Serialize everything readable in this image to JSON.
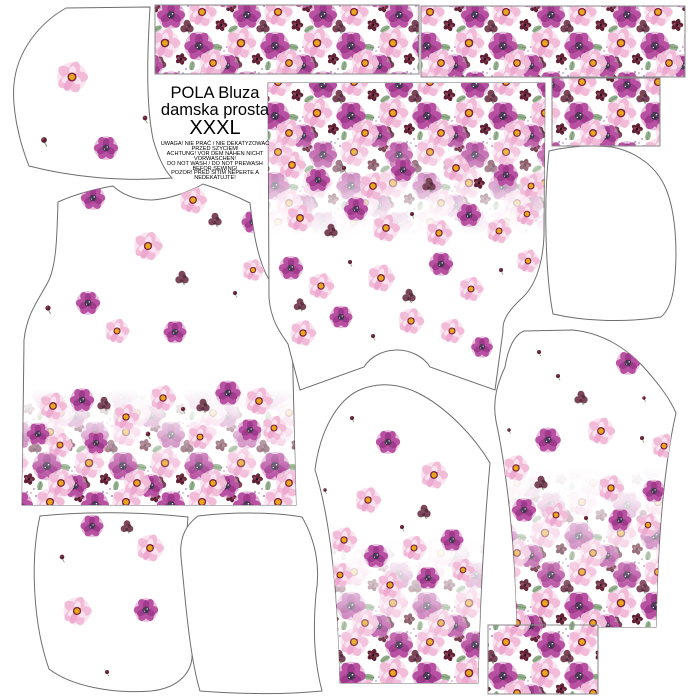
{
  "meta": {
    "title1": "POLA Bluza",
    "title2": "damska prosta",
    "size": "XXXL"
  },
  "warnings": [
    "UWAGA! NIE PRAĆ / NIE DEKATYZOWAĆ",
    "PRZED SZYCIEM!",
    "ACHTUNG! VOR DEM NÄHEN NICHT",
    "VORWASCHEN!",
    "DO NOT WASH / DO NOT PREWASH",
    "BEFOR SEWING!",
    "POZOR! PŘED ŠITÍM NEPERTE A",
    "NEDEKATUJTE!"
  ],
  "colors": {
    "outline": "#6e6e6e",
    "rect_border": "#8a8a8a",
    "magenta": "#b851a2",
    "magenta_dark": "#a03a8c",
    "pink_light": "#f2bcd9",
    "pink_pale": "#f7d9ea",
    "yellow_center": "#e9a81c",
    "wine": "#5f2133",
    "clover": "#7c4659",
    "leaf_green": "#93b08c",
    "flower_eye": "#4a3a56"
  },
  "dense_rects": [
    {
      "id": "top-border-strip-left",
      "x": 155,
      "y": 5,
      "w": 264,
      "h": 69
    },
    {
      "id": "top-border-strip-right",
      "x": 421,
      "y": 6,
      "w": 264,
      "h": 71
    },
    {
      "id": "cuff-rect-top-right",
      "x": 552,
      "y": 78,
      "w": 108,
      "h": 68
    },
    {
      "id": "cuff-rect-bottom-right",
      "x": 488,
      "y": 625,
      "w": 110,
      "h": 69
    }
  ],
  "pieces": [
    {
      "id": "hood-side-top-left",
      "path": "M 66,8 L 150,7 C 147,58 146,104 153,139 C 158,157 164,170 172,178 C 122,182 72,177 29,166 C 17,136 12,104 14,84 C 17,52 38,24 66,8 Z",
      "flowers": [
        [
          "pinkY",
          72,
          77,
          1.15
        ],
        [
          "bud",
          44,
          140,
          1.0
        ],
        [
          "magenta",
          106,
          148,
          0.95
        ],
        [
          "bud",
          145,
          118,
          0.8
        ]
      ]
    },
    {
      "id": "front-bodice-left",
      "path": "M 58,202 C 76,194 95,189 113,186 C 125,197 140,200 152,200 C 168,199 187,193 203,184 C 219,189 236,196 250,203 C 253,230 257,255 266,274 C 276,293 290,308 292,332 L 296,505 L 22,505 L 24,340 C 27,312 40,298 49,280 C 57,262 57,230 58,202 Z",
      "band": {
        "x": 22,
        "y": 388,
        "w": 276,
        "h": 118,
        "solid": "bottom"
      },
      "flowers": [
        [
          "magenta",
          93,
          198,
          0.95
        ],
        [
          "pinkY",
          193,
          200,
          1.0
        ],
        [
          "clover",
          215,
          220,
          0.8
        ],
        [
          "magenta",
          253,
          222,
          0.9
        ],
        [
          "pinkY",
          148,
          246,
          1.05
        ],
        [
          "pinkY",
          253,
          270,
          0.8
        ],
        [
          "magenta",
          88,
          303,
          0.95
        ],
        [
          "bud",
          48,
          308,
          0.9
        ],
        [
          "clover",
          182,
          278,
          0.8
        ],
        [
          "bud",
          235,
          293,
          0.7
        ],
        [
          "magenta",
          175,
          332,
          0.9
        ],
        [
          "pinkY",
          117,
          331,
          0.9
        ],
        [
          "pinkY",
          53,
          406,
          1.0
        ],
        [
          "magenta",
          82,
          400,
          0.95
        ],
        [
          "clover",
          104,
          404,
          0.8
        ],
        [
          "pinkY",
          126,
          417,
          0.95
        ],
        [
          "bud",
          148,
          434,
          0.8
        ],
        [
          "pinkY",
          163,
          398,
          0.95
        ],
        [
          "bud",
          183,
          409,
          0.7
        ],
        [
          "clover",
          203,
          406,
          0.8
        ],
        [
          "magenta",
          228,
          393,
          1.0
        ],
        [
          "pinkY",
          259,
          401,
          1.0
        ],
        [
          "pinkY",
          274,
          428,
          0.9
        ],
        [
          "magenta",
          38,
          434,
          0.9
        ],
        [
          "pinkY",
          60,
          445,
          0.9
        ],
        [
          "magenta",
          96,
          443,
          0.9
        ],
        [
          "pinkY",
          200,
          437,
          0.9
        ],
        [
          "magenta",
          250,
          430,
          0.9
        ]
      ]
    },
    {
      "id": "back-bodice-center",
      "path": "M 268,83 L 545,83 L 544,235 C 543,262 536,286 521,299 C 508,311 502,321 503,331 L 495,390 L 430,367 C 424,357 411,350 397,350 C 383,350 370,357 364,367 L 300,390 L 288,344 C 279,331 271,320 269,298 Z",
      "band": {
        "x": 268,
        "y": 83,
        "w": 277,
        "h": 152,
        "solid": "top"
      },
      "flowers": [
        [
          "pinkY",
          292,
          165,
          1.0
        ],
        [
          "magenta",
          318,
          180,
          0.95
        ],
        [
          "bud",
          344,
          168,
          0.7
        ],
        [
          "pinkY",
          373,
          186,
          1.0
        ],
        [
          "magenta",
          403,
          170,
          0.95
        ],
        [
          "clover",
          429,
          185,
          0.8
        ],
        [
          "pinkY",
          456,
          168,
          1.0
        ],
        [
          "wine",
          479,
          183,
          0.8
        ],
        [
          "magenta",
          506,
          175,
          0.95
        ],
        [
          "pinkY",
          531,
          186,
          0.9
        ],
        [
          "pinkY",
          300,
          218,
          1.0
        ],
        [
          "clover",
          331,
          231,
          0.8
        ],
        [
          "magenta",
          356,
          209,
          0.95
        ],
        [
          "pinkY",
          386,
          228,
          1.0
        ],
        [
          "bud",
          412,
          214,
          0.7
        ],
        [
          "pinkY",
          439,
          233,
          0.95
        ],
        [
          "magenta",
          469,
          215,
          0.95
        ],
        [
          "pinkY",
          499,
          231,
          0.9
        ],
        [
          "pinkY",
          527,
          214,
          0.85
        ],
        [
          "magenta",
          291,
          268,
          0.95
        ],
        [
          "pinkY",
          321,
          286,
          0.95
        ],
        [
          "bud",
          350,
          262,
          0.7
        ],
        [
          "pinkY",
          381,
          278,
          1.0
        ],
        [
          "clover",
          409,
          296,
          0.8
        ],
        [
          "magenta",
          441,
          264,
          0.95
        ],
        [
          "pinkY",
          471,
          289,
          0.9
        ],
        [
          "bud",
          501,
          270,
          0.7
        ],
        [
          "pinkY",
          528,
          261,
          0.85
        ],
        [
          "pinkY",
          303,
          333,
          0.95
        ],
        [
          "magenta",
          341,
          317,
          0.9
        ],
        [
          "bud",
          373,
          336,
          0.7
        ],
        [
          "pinkY",
          411,
          321,
          0.95
        ],
        [
          "pinkY",
          452,
          331,
          0.9
        ],
        [
          "magenta",
          482,
          347,
          0.85
        ],
        [
          "bud",
          515,
          323,
          0.7
        ],
        [
          "clover",
          300,
          305,
          0.75
        ]
      ]
    },
    {
      "id": "sleeve-bottom-center",
      "path": "M 315,470 C 320,430 338,398 362,389 C 380,382 400,384 418,393 C 446,407 474,436 490,463 C 484,530 480,600 478,683 L 340,683 C 338,600 331,520 315,470 Z",
      "band": {
        "x": 314,
        "y": 538,
        "w": 177,
        "h": 146,
        "solid": "bottom"
      },
      "flowers": [
        [
          "bud",
          352,
          418,
          0.7
        ],
        [
          "magenta",
          388,
          442,
          0.95
        ],
        [
          "pinkY",
          434,
          475,
          1.0
        ],
        [
          "pinkY",
          368,
          500,
          0.95
        ],
        [
          "clover",
          424,
          512,
          0.8
        ],
        [
          "bud",
          325,
          490,
          0.6
        ],
        [
          "bud",
          402,
          527,
          0.7
        ],
        [
          "pinkY",
          344,
          540,
          0.95
        ],
        [
          "magenta",
          376,
          556,
          0.95
        ],
        [
          "pinkY",
          414,
          548,
          0.9
        ],
        [
          "magenta",
          452,
          540,
          0.9
        ],
        [
          "pinkY",
          340,
          575,
          0.9
        ],
        [
          "pinkY",
          390,
          585,
          0.95
        ],
        [
          "magenta",
          428,
          578,
          0.9
        ],
        [
          "pinkY",
          463,
          570,
          0.85
        ]
      ]
    },
    {
      "id": "sleeve-right",
      "path": "M 505,367 C 508,349 514,335 524,331 L 573,330 C 602,333 628,348 648,372 C 660,386 670,399 676,413 C 663,470 658,545 656,627 L 517,627 C 515,540 506,468 496,421 C 492,400 498,382 505,367 Z",
      "band": {
        "x": 494,
        "y": 468,
        "w": 184,
        "h": 160,
        "solid": "bottom"
      },
      "flowers": [
        [
          "bud",
          539,
          352,
          0.7
        ],
        [
          "magenta",
          628,
          363,
          0.95
        ],
        [
          "bud",
          558,
          376,
          0.7
        ],
        [
          "clover",
          581,
          398,
          0.8
        ],
        [
          "bud",
          644,
          398,
          0.6
        ],
        [
          "magenta",
          548,
          440,
          1.0
        ],
        [
          "pinkY",
          601,
          431,
          1.0
        ],
        [
          "bud",
          642,
          438,
          0.7
        ],
        [
          "pinkY",
          664,
          446,
          0.9
        ],
        [
          "bud",
          509,
          430,
          0.6
        ],
        [
          "pinkY",
          516,
          468,
          0.95
        ],
        [
          "clover",
          541,
          483,
          0.8
        ],
        [
          "pinkY",
          611,
          488,
          0.95
        ],
        [
          "magenta",
          654,
          491,
          0.9
        ],
        [
          "magenta",
          524,
          510,
          0.95
        ],
        [
          "pinkY",
          556,
          515,
          0.9
        ],
        [
          "bud",
          586,
          518,
          0.7
        ],
        [
          "magenta",
          620,
          520,
          0.9
        ],
        [
          "pinkY",
          648,
          525,
          0.85
        ]
      ]
    },
    {
      "id": "hood-side-right",
      "path": "M 549,151 C 570,146 592,145 612,147 C 637,152 657,167 666,189 C 676,213 678,252 674,286 C 672,301 668,311 661,317 C 624,323 583,321 553,314 C 546,278 543,206 549,151 Z",
      "flowers": []
    },
    {
      "id": "hood-piece-bottom-left-a",
      "path": "M 40,516 C 86,511 140,512 188,517 C 184,562 186,612 192,650 C 194,672 179,688 151,691 C 112,694 71,686 49,669 C 33,624 30,560 40,516 Z",
      "flowers": [
        [
          "magenta",
          92,
          526,
          0.9
        ],
        [
          "clover",
          127,
          527,
          0.75
        ],
        [
          "pinkY",
          150,
          548,
          1.0
        ],
        [
          "bud",
          62,
          557,
          0.8
        ],
        [
          "pinkY",
          77,
          611,
          1.05
        ],
        [
          "magenta",
          146,
          610,
          0.95
        ],
        [
          "bud",
          107,
          672,
          0.7
        ]
      ]
    },
    {
      "id": "hood-piece-bottom-left-b",
      "path": "M 198,516 C 240,511 280,513 302,517 C 317,543 320,570 316,594 C 312,640 316,668 322,691 C 281,695 239,694 200,691 C 189,654 185,595 181,557 C 179,537 187,524 198,516 Z",
      "flowers": []
    }
  ]
}
